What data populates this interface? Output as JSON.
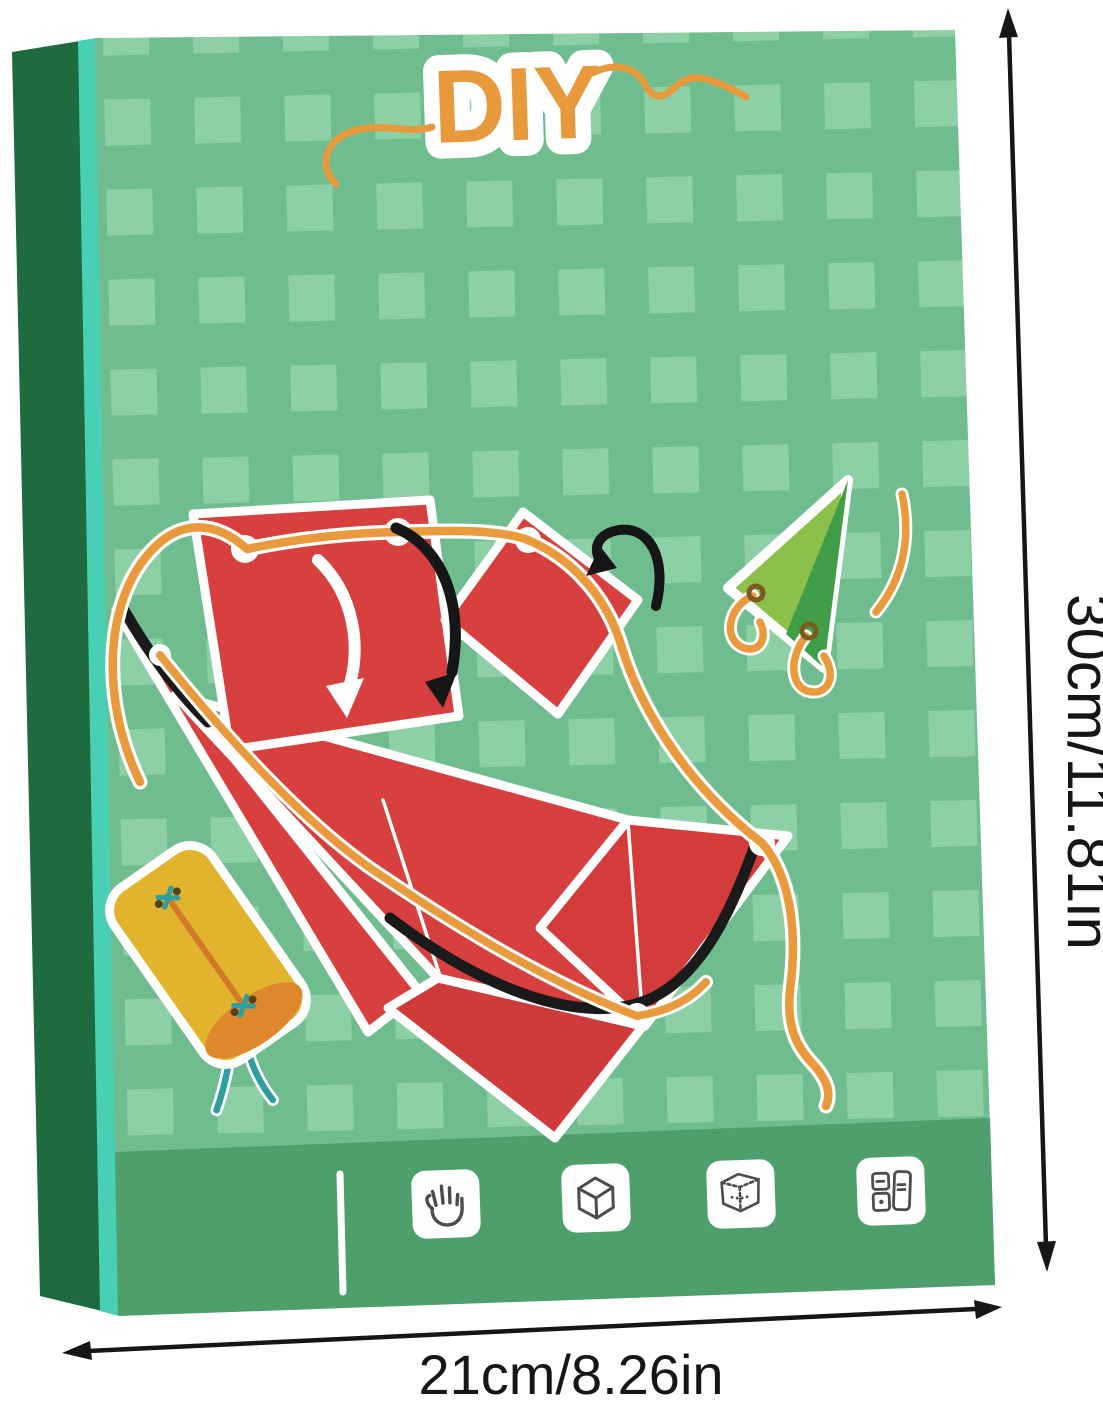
{
  "product_image": {
    "logo": {
      "text": "DIY",
      "color": "#E8993C"
    },
    "dimension_labels": {
      "height": "30cm/11.81in",
      "width": "21cm/8.26in",
      "annotation_color": "#161616"
    },
    "box": {
      "front_color": "#6FBD8E",
      "checker_color": "#8ED0A6",
      "spine_color": "#1D6B3E",
      "spine_highlight_color": "#49CFB4",
      "footer_band_color": "#4F9F6C",
      "footer_icons": [
        {
          "name": "hand-icon"
        },
        {
          "name": "cube-icon"
        },
        {
          "name": "cube-dashed-icon"
        },
        {
          "name": "cards-icon"
        }
      ]
    },
    "illustration": {
      "paper_color": "#D84040",
      "string_color": "#E89A3C",
      "triangle_light": "#8CC04B",
      "triangle_dark": "#3F9E47",
      "cylinder_color": "#E2B42D",
      "cylinder_end_color": "#DE872B",
      "stitch_color": "#2F9E9E",
      "fold_arrow_white": "#FFFFFF",
      "fold_arrow_black": "#161616"
    }
  }
}
